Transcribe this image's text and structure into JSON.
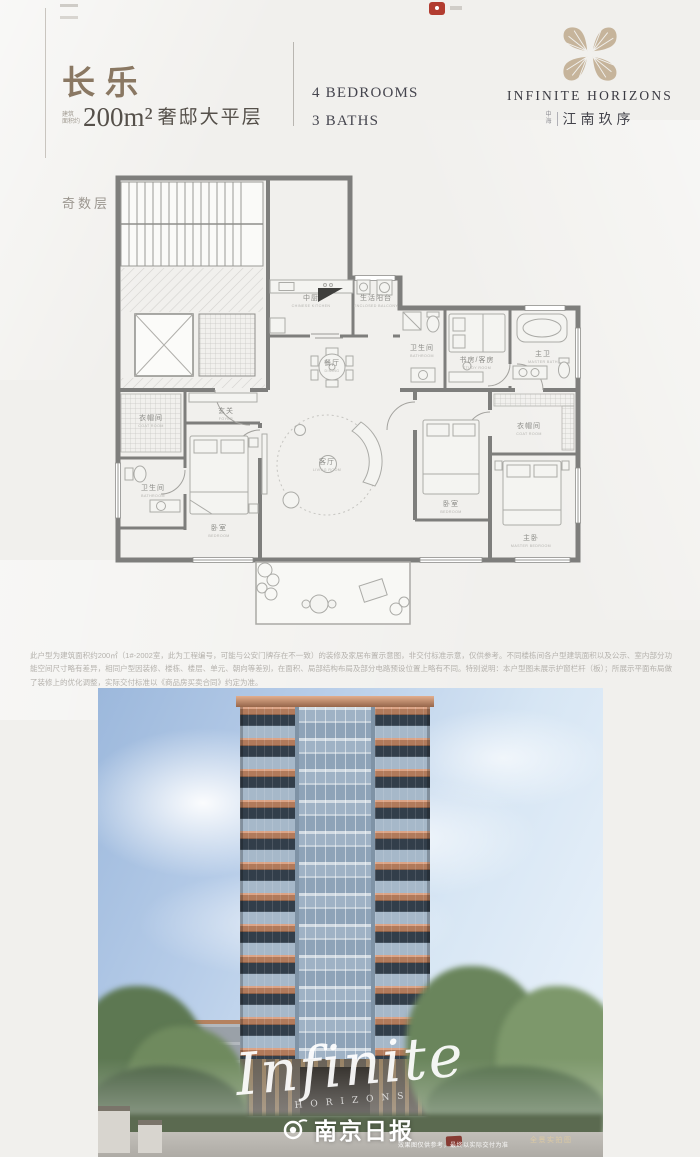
{
  "header": {
    "title": "长乐",
    "area_prefix_top": "建筑",
    "area_prefix_bottom": "面积约",
    "area_value": "200m²",
    "area_desc": "奢邸大平层",
    "bedrooms": "4 BEDROOMS",
    "baths": "3 BATHS"
  },
  "brand": {
    "name_en": "INFINITE HORIZONS",
    "prefix_top": "中",
    "prefix_bottom": "海",
    "name_cn": "江南玖序"
  },
  "floorplan": {
    "floor_label": "奇数层",
    "rooms": [
      {
        "cn": "中厨",
        "en": "CHINESE KITCHEN"
      },
      {
        "cn": "生活阳台",
        "en": "ENCLOSED BALCONY"
      },
      {
        "cn": "餐厅",
        "en": "DINING"
      },
      {
        "cn": "书房/客房",
        "en": "STUDY ROOM"
      },
      {
        "cn": "主卫",
        "en": "MASTER BATH"
      },
      {
        "cn": "卫生间",
        "en": "BATHROOM"
      },
      {
        "cn": "玄关",
        "en": "FOYER"
      },
      {
        "cn": "衣帽间",
        "en": "COAT ROOM"
      },
      {
        "cn": "卫生间",
        "en": "BATHROOM"
      },
      {
        "cn": "卧室",
        "en": "BEDROOM"
      },
      {
        "cn": "客厅",
        "en": "LIVING ROOM"
      },
      {
        "cn": "卧室",
        "en": "BEDROOM"
      },
      {
        "cn": "衣帽间",
        "en": "COAT ROOM"
      },
      {
        "cn": "主卧",
        "en": "MASTER BEDROOM"
      }
    ]
  },
  "disclaimer": "此户型为建筑面积约200㎡（1#-2002室，此为工程编号，可能与公安门牌存在不一致）的装修及家居布置示意图，非交付标准示意，仅供参考。不同楼栋间各户型建筑面积以及公示、室内部分功能空间尺寸略有差异，相同户型因装修、楼栋、楼层、单元、朝向等差别，在面积、局部结构布局及部分电路预设位置上略有不同。特别说明：本户型图未展示护窗栏杆（板）；所展示平面布局做了装修上的优化调整，实际交付标准以《商品房买卖合同》约定为准。",
  "photo": {
    "watermark_script": "Infinite",
    "watermark_sub": "HORIZONS",
    "press_name": "南京日报",
    "caption_left": "效果图仅供参考，最终以实际交付为准",
    "caption_right": "全景实拍图"
  },
  "colors": {
    "title_gold": "#8a7863",
    "logo_tan": "#c6b49b",
    "ink": "#45454e",
    "terracotta": "#b17a5b",
    "sky_left": "#9cb8dc",
    "sky_right": "#edf4fb"
  }
}
